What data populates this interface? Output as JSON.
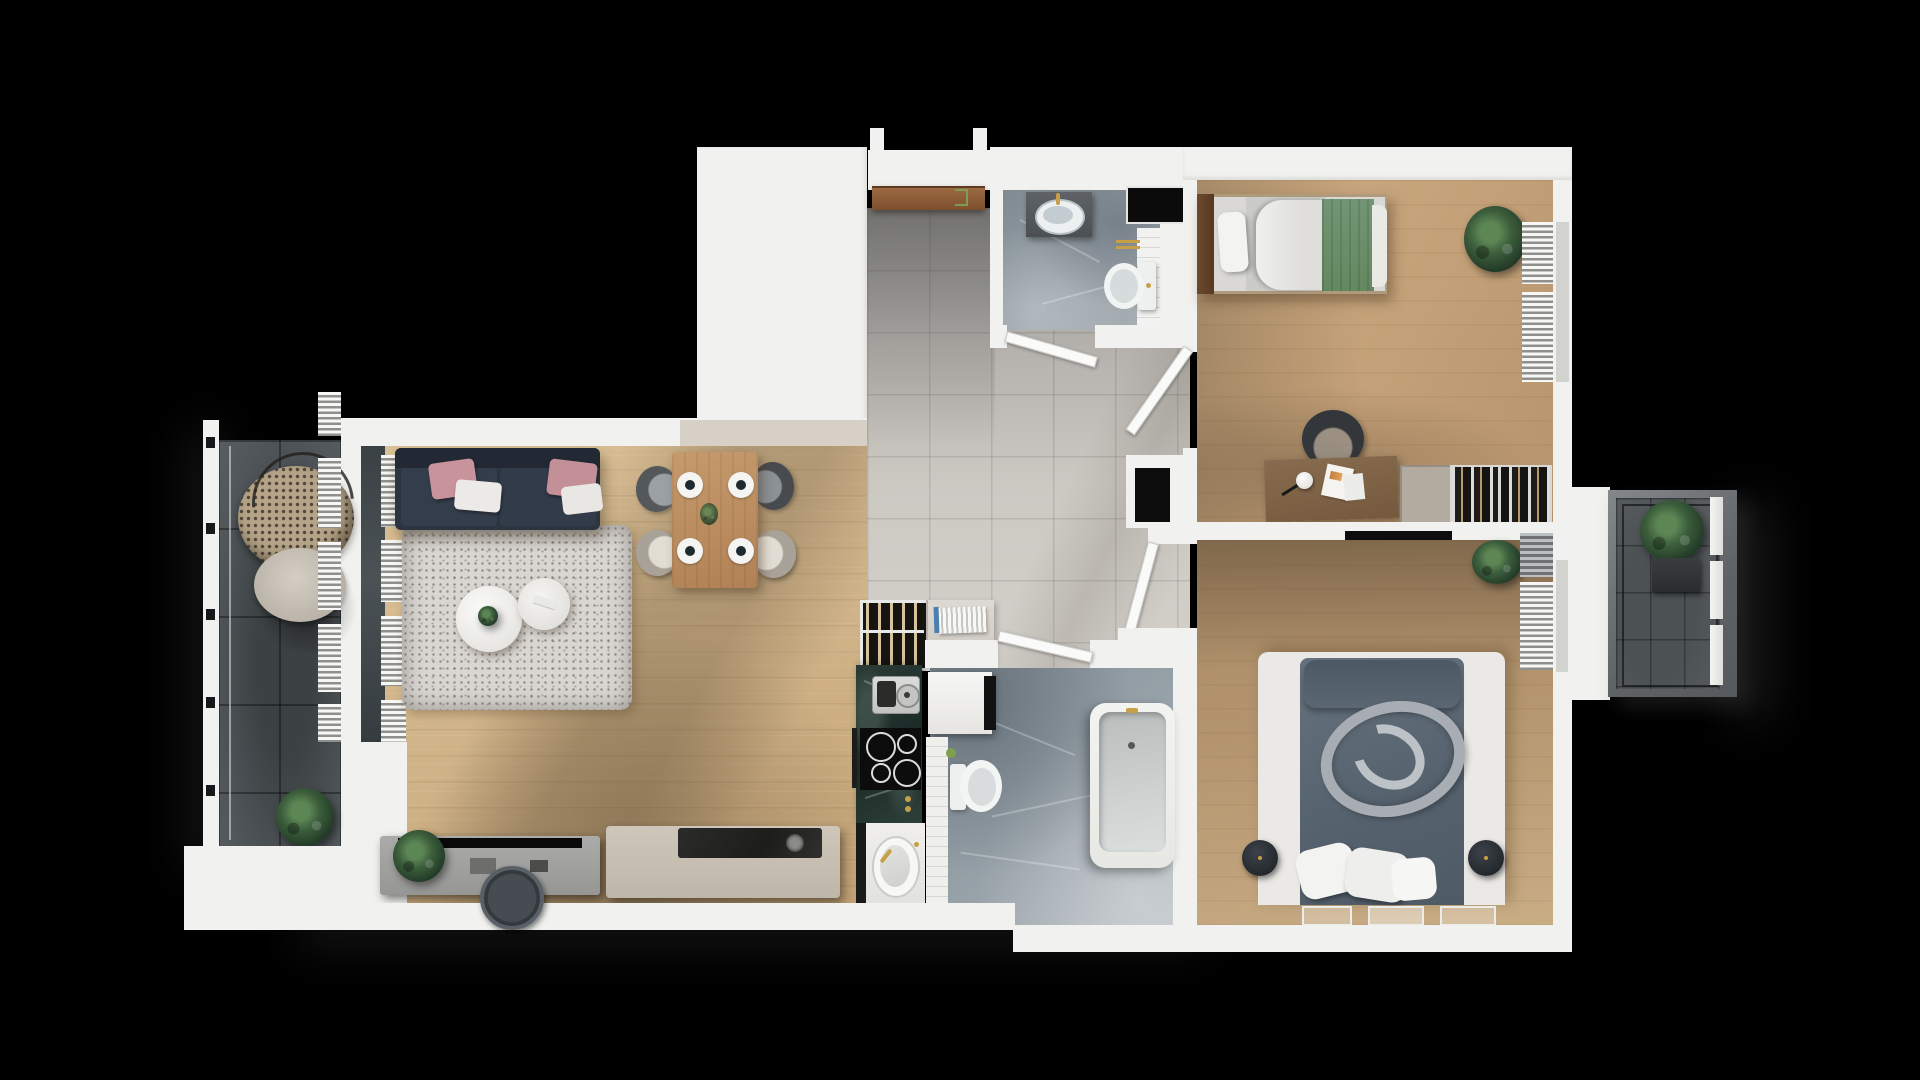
{
  "scene": {
    "title": "Top-down 3D rendered apartment floor plan",
    "background_color": "#000000",
    "style": "photoreal architectural render, no text labels"
  },
  "palette": {
    "walls": "#f1f1ef",
    "wood_living": "#d2b68b",
    "wood_bedroom_1": "#cbaa80",
    "wood_bedroom_2": "#b3946e",
    "hall_tiles": "#c9c6c0",
    "marble_bath": "#95a0a8",
    "balcony_tiles": "#484d50",
    "sofa_navy": "#2c3440",
    "pillow_pink": "#c9939b",
    "blanket_green": "#6d8f70",
    "duvet_slate": "#5d6a77",
    "counter_marble_dark": "#243430",
    "accent_gold": "#c79f47"
  },
  "rooms": [
    {
      "id": "left-balcony",
      "label": "Balcony (left)",
      "floor": "dark gray tiles",
      "furniture": [
        "hanging rattan egg chair",
        "potted plant",
        "railing posts"
      ]
    },
    {
      "id": "living-room",
      "label": "Living room / dining",
      "floor": "light oak",
      "furniture": [
        "navy sofa with pink and white pillows",
        "speckled shag rug",
        "two round white coffee tables",
        "wood dining table",
        "four chairs (two gray, two beige)",
        "four place settings",
        "tv console with tv",
        "round dark rug",
        "kitchen island",
        "potted plants"
      ]
    },
    {
      "id": "kitchen",
      "label": "Kitchen run",
      "floor": "gray tiles",
      "furniture": [
        "wine rack with bottles",
        "open shelf with books",
        "dark marble counter",
        "coffee machine",
        "induction cooktop with four burners",
        "oven handle",
        "sink with gold faucet"
      ]
    },
    {
      "id": "hallway",
      "label": "Entrance hall / corridor",
      "floor": "gray tiles",
      "furniture": [
        "brown entrance door with gold hook"
      ]
    },
    {
      "id": "wc",
      "label": "Guest WC",
      "floor": "gray marble",
      "furniture": [
        "dark vanity with oval sink and gold faucet",
        "toilet",
        "white tiled strip",
        "black appliance niche",
        "gold towel bar",
        "swing door"
      ]
    },
    {
      "id": "bathroom",
      "label": "Bathroom",
      "floor": "gray marble",
      "furniture": [
        "white vanity with dark mirror",
        "toilet with green cup",
        "bathtub with gold faucet",
        "white tiled strip",
        "swing door"
      ]
    },
    {
      "id": "bedroom-1",
      "label": "Bedroom (top right)",
      "floor": "oak",
      "furniture": [
        "single bed with white pillow and green blanket",
        "wood headboard",
        "desk with lamp and papers",
        "office chair",
        "beige cabinet",
        "wardrobe with hanging clothes",
        "potted plant",
        "louvered blinds"
      ]
    },
    {
      "id": "bedroom-2",
      "label": "Master bedroom",
      "floor": "oak",
      "furniture": [
        "double bed with slate duvet",
        "gray rolled throw",
        "white pillows",
        "two round poufs",
        "wall-mounted tv",
        "three floor mats",
        "potted plant",
        "gray radiator",
        "louvered blinds"
      ]
    },
    {
      "id": "right-balcony",
      "label": "Balcony (right)",
      "floor": "dark gray tiles",
      "furniture": [
        "planter with green plant",
        "white slat panels",
        "metal railing"
      ]
    }
  ]
}
